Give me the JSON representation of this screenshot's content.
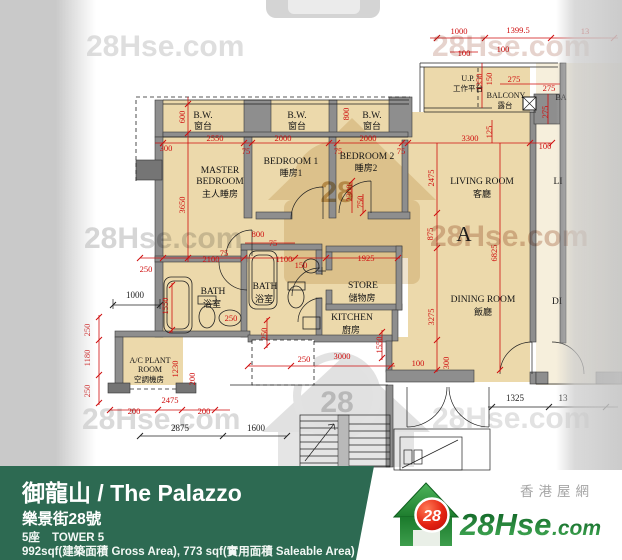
{
  "colors": {
    "floor_tan": "#ecd9ab",
    "adjacent_cream": "#f6efdc",
    "wall_gray": "#8e8e8e",
    "dim_red": "#cf0e0e",
    "footer_green": "#2d6a52",
    "logo_green": "#1e7a31",
    "badge_red": "#d01010"
  },
  "plan": {
    "unit_label": "A",
    "rooms": [
      {
        "t": "B.W.",
        "x": 203,
        "y": 118,
        "c": "e"
      },
      {
        "t": "窗台",
        "x": 203,
        "y": 129,
        "c": "c"
      },
      {
        "t": "B.W.",
        "x": 297,
        "y": 118,
        "c": "e"
      },
      {
        "t": "窗台",
        "x": 297,
        "y": 129,
        "c": "c"
      },
      {
        "t": "B.W.",
        "x": 372,
        "y": 118,
        "c": "e"
      },
      {
        "t": "窗台",
        "x": 372,
        "y": 129,
        "c": "c"
      },
      {
        "t": "MASTER",
        "x": 220,
        "y": 173,
        "c": "e"
      },
      {
        "t": "BEDROOM",
        "x": 220,
        "y": 184,
        "c": "e"
      },
      {
        "t": "主人睡房",
        "x": 220,
        "y": 197,
        "c": "c"
      },
      {
        "t": "BEDROOM 1",
        "x": 291,
        "y": 164,
        "c": "e"
      },
      {
        "t": "睡房1",
        "x": 291,
        "y": 176,
        "c": "c"
      },
      {
        "t": "BEDROOM 2",
        "x": 367,
        "y": 159,
        "c": "e"
      },
      {
        "t": "睡房2",
        "x": 366,
        "y": 171,
        "c": "c"
      },
      {
        "t": "LIVING ROOM",
        "x": 482,
        "y": 184,
        "c": "e"
      },
      {
        "t": "客廳",
        "x": 482,
        "y": 197,
        "c": "c"
      },
      {
        "t": "A",
        "x": 464,
        "y": 241,
        "c": "A"
      },
      {
        "t": "DINING ROOM",
        "x": 483,
        "y": 302,
        "c": "e"
      },
      {
        "t": "飯廳",
        "x": 483,
        "y": 315,
        "c": "c"
      },
      {
        "t": "U.P.",
        "x": 468,
        "y": 81,
        "c": "s"
      },
      {
        "t": "工作平台",
        "x": 468,
        "y": 91,
        "c": "sc"
      },
      {
        "t": "BALCONY",
        "x": 506,
        "y": 98,
        "c": "s"
      },
      {
        "t": "露台",
        "x": 505,
        "y": 108,
        "c": "sc"
      },
      {
        "t": "BATH",
        "x": 213,
        "y": 294,
        "c": "e"
      },
      {
        "t": "浴室",
        "x": 212,
        "y": 307,
        "c": "c"
      },
      {
        "t": "BATH",
        "x": 265,
        "y": 289,
        "c": "e"
      },
      {
        "t": "浴室",
        "x": 264,
        "y": 302,
        "c": "c"
      },
      {
        "t": "STORE",
        "x": 363,
        "y": 288,
        "c": "e"
      },
      {
        "t": "儲物房",
        "x": 362,
        "y": 301,
        "c": "c"
      },
      {
        "t": "KITCHEN",
        "x": 352,
        "y": 320,
        "c": "e"
      },
      {
        "t": "廚房",
        "x": 351,
        "y": 333,
        "c": "c"
      },
      {
        "t": "A/C PLANT",
        "x": 150,
        "y": 363,
        "c": "s"
      },
      {
        "t": "ROOM",
        "x": 150,
        "y": 372,
        "c": "s"
      },
      {
        "t": "空調機房",
        "x": 149,
        "y": 382,
        "c": "sc"
      },
      {
        "t": "LI",
        "x": 558,
        "y": 184,
        "c": "e"
      },
      {
        "t": "DI",
        "x": 557,
        "y": 304,
        "c": "e"
      },
      {
        "t": "BA",
        "x": 561,
        "y": 100,
        "c": "s"
      }
    ],
    "dims_red": [
      {
        "t": "1000",
        "x": 459,
        "y": 34
      },
      {
        "t": "1399.5",
        "x": 518,
        "y": 33
      },
      {
        "t": "13",
        "x": 585,
        "y": 34
      },
      {
        "t": "100",
        "x": 464,
        "y": 56
      },
      {
        "t": "100",
        "x": 503,
        "y": 52
      },
      {
        "t": "1350",
        "x": 482,
        "y": 82,
        "v": 1
      },
      {
        "t": "150",
        "x": 492,
        "y": 79,
        "v": 1
      },
      {
        "t": "275",
        "x": 514,
        "y": 82
      },
      {
        "t": "275",
        "x": 549,
        "y": 91
      },
      {
        "t": "275",
        "x": 548,
        "y": 112,
        "v": 1
      },
      {
        "t": "125",
        "x": 492,
        "y": 132,
        "v": 1
      },
      {
        "t": "300",
        "x": 166,
        "y": 151
      },
      {
        "t": "2550",
        "x": 215,
        "y": 141
      },
      {
        "t": "75",
        "x": 246,
        "y": 154
      },
      {
        "t": "2000",
        "x": 283,
        "y": 141
      },
      {
        "t": "75",
        "x": 338,
        "y": 154
      },
      {
        "t": "2000",
        "x": 368,
        "y": 141
      },
      {
        "t": "75",
        "x": 401,
        "y": 154
      },
      {
        "t": "3300",
        "x": 470,
        "y": 141
      },
      {
        "t": "100",
        "x": 545,
        "y": 149
      },
      {
        "t": "600",
        "x": 185,
        "y": 117,
        "v": 1
      },
      {
        "t": "3650",
        "x": 185,
        "y": 205,
        "v": 1
      },
      {
        "t": "800",
        "x": 349,
        "y": 114,
        "v": 1
      },
      {
        "t": "2300",
        "x": 352,
        "y": 193,
        "v": 1
      },
      {
        "t": "750",
        "x": 363,
        "y": 202,
        "v": 1
      },
      {
        "t": "2475",
        "x": 434,
        "y": 178,
        "v": 1
      },
      {
        "t": "875",
        "x": 433,
        "y": 234,
        "v": 1
      },
      {
        "t": "3275",
        "x": 434,
        "y": 317,
        "v": 1
      },
      {
        "t": "300",
        "x": 449,
        "y": 363,
        "v": 1
      },
      {
        "t": "6825",
        "x": 497,
        "y": 253,
        "v": 1
      },
      {
        "t": "800",
        "x": 258,
        "y": 237
      },
      {
        "t": "75",
        "x": 273,
        "y": 246
      },
      {
        "t": "2100",
        "x": 211,
        "y": 262
      },
      {
        "t": "250",
        "x": 146,
        "y": 272
      },
      {
        "t": "1100",
        "x": 284,
        "y": 262
      },
      {
        "t": "150",
        "x": 301,
        "y": 268
      },
      {
        "t": "1925",
        "x": 366,
        "y": 261
      },
      {
        "t": "75",
        "x": 224,
        "y": 256
      },
      {
        "t": "1550",
        "x": 168,
        "y": 306,
        "v": 1
      },
      {
        "t": "250",
        "x": 231,
        "y": 321
      },
      {
        "t": "250",
        "x": 267,
        "y": 334,
        "v": 1
      },
      {
        "t": "250",
        "x": 90,
        "y": 330,
        "v": 1
      },
      {
        "t": "1180",
        "x": 90,
        "y": 358,
        "v": 1
      },
      {
        "t": "250",
        "x": 90,
        "y": 391,
        "v": 1
      },
      {
        "t": "1230",
        "x": 178,
        "y": 369,
        "v": 1
      },
      {
        "t": "200",
        "x": 195,
        "y": 379,
        "v": 1
      },
      {
        "t": "2475",
        "x": 170,
        "y": 403
      },
      {
        "t": "200",
        "x": 134,
        "y": 414
      },
      {
        "t": "200",
        "x": 204,
        "y": 414
      },
      {
        "t": "250",
        "x": 304,
        "y": 362
      },
      {
        "t": "3000",
        "x": 342,
        "y": 359
      },
      {
        "t": "1550",
        "x": 382,
        "y": 345,
        "v": 1
      },
      {
        "t": "100",
        "x": 418,
        "y": 366
      }
    ],
    "dims_black": [
      {
        "t": "1000",
        "x": 135,
        "y": 298
      },
      {
        "t": "2875",
        "x": 180,
        "y": 431
      },
      {
        "t": "1600",
        "x": 256,
        "y": 431
      },
      {
        "t": "1325",
        "x": 515,
        "y": 401
      },
      {
        "t": "13",
        "x": 563,
        "y": 401
      }
    ]
  },
  "watermarks": [
    {
      "t": "28Hse.com",
      "x": 86,
      "y": 56,
      "f": "#d9d9d9"
    },
    {
      "t": "28Hse.com",
      "x": 84,
      "y": 248,
      "f": "#cfcfcf"
    },
    {
      "t": "28Hse.com",
      "x": 432,
      "y": 56,
      "f": "#e2ccc5"
    },
    {
      "t": "28Hse.com",
      "x": 430,
      "y": 246,
      "f": "#d9bcae"
    },
    {
      "t": "28Hse.com",
      "x": 82,
      "y": 429,
      "f": "#d4d4d4"
    },
    {
      "t": "28Hse.com",
      "x": 432,
      "y": 428,
      "f": "#dddddd"
    },
    {
      "t": "28",
      "x": 337,
      "y": 202,
      "f": "#c9a96b",
      "s": 44
    },
    {
      "t": "28",
      "x": 337,
      "y": 412,
      "f": "#c9c9c9",
      "s": 44
    }
  ],
  "footer": {
    "title": "御龍山 / The Palazzo",
    "address": "樂景街28號",
    "tower_zh": "5座",
    "tower_en": "TOWER 5",
    "area": "992sqf(建築面積 Gross Area), 773 sqf(實用面積 Saleable Area)"
  },
  "logo": {
    "main": "28Hse",
    "tld": ".com",
    "badge": "28",
    "tagline": "香港屋網"
  }
}
